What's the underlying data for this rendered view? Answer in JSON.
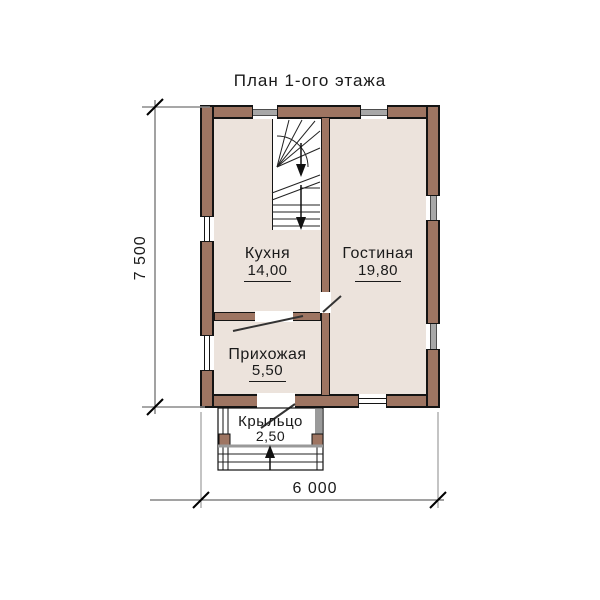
{
  "title": "План 1-ого этажа",
  "rooms": {
    "kitchen": {
      "name": "Кухня",
      "area": "14,00"
    },
    "living": {
      "name": "Гостиная",
      "area": "19,80"
    },
    "hallway": {
      "name": "Прихожая",
      "area": "5,50"
    },
    "porch": {
      "name": "Крыльцо",
      "area": "2,50"
    }
  },
  "dimensions": {
    "height_total": "7 500",
    "width_total": "6 000"
  },
  "symbols": {
    "stairs": "winder-staircase-down",
    "stair_arrow_direction": "down",
    "entry_arrow_direction": "up",
    "window_count": 7,
    "door_count": 3
  },
  "colors": {
    "wall_fill": "#9e7562",
    "wall_outline": "#141414",
    "floor_fill": "#ece3dc",
    "window_gray": "#a8a8a8",
    "dimension_line": "#555555",
    "text": "#1a1a1a",
    "background": "#ffffff"
  }
}
